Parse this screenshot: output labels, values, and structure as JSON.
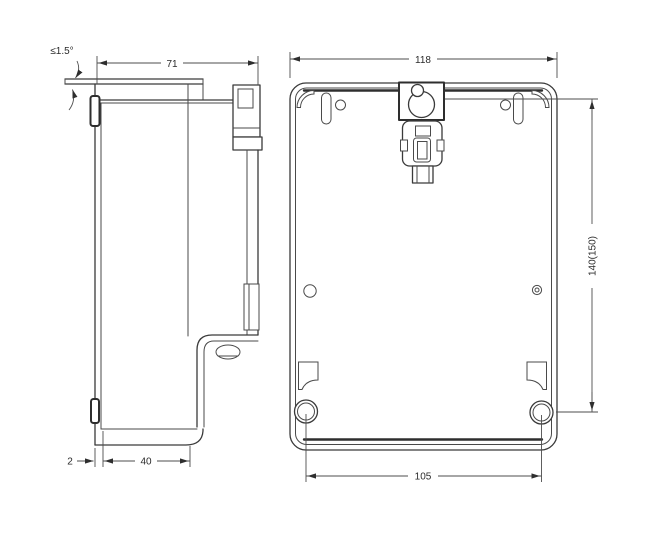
{
  "drawing": {
    "type": "engineering-dimension-drawing",
    "background_color": "#ffffff",
    "line_color": "#3a3a3a",
    "dim_line_color": "#4d4d4d",
    "text_color": "#2b2b2b",
    "views": {
      "side_view": {
        "label": "side-profile-view",
        "dimensions": {
          "top_width": "71",
          "tilt_angle": "≤1.5°",
          "back_gap": "2",
          "terminal_depth": "40"
        }
      },
      "rear_view": {
        "label": "rear-mounting-view",
        "dimensions": {
          "body_width": "118",
          "mounting_height": "140(150)",
          "hole_spacing": "105"
        }
      }
    }
  }
}
